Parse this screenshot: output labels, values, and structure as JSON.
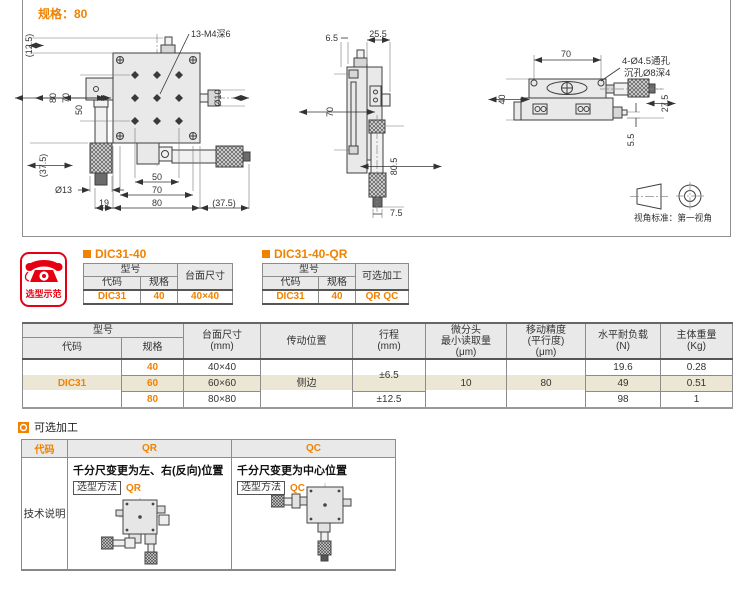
{
  "colors": {
    "orange": "#f08200",
    "red": "#e60012",
    "beige": "#ece7d4",
    "header_bg": "#e9e9e9"
  },
  "spec_label": "规格：80",
  "drawing": {
    "front": {
      "holes_label": "13-M4深6",
      "d10": "Ø10",
      "d13": "Ø13",
      "dim_12_5": "(12.5)",
      "dim_80_left": "80",
      "dim_70_left": "70",
      "dim_50_left": "50",
      "dim_37_5_left": "(37.5)",
      "dim_19": "19",
      "dim_50_bottom": "50",
      "dim_70_bottom": "70",
      "dim_80_bottom": "80",
      "dim_37_5_bottom": "(37.5)"
    },
    "side": {
      "dim_6_5": "6.5",
      "dim_25_5": "25.5",
      "dim_70": "70",
      "dim_80_5": "80.5",
      "dim_7_5": "7.5"
    },
    "end": {
      "dim_70": "70",
      "note1": "4-Ø4.5通孔",
      "note2": "沉孔Ø8深4",
      "dim_40": "40",
      "dim_27_5": "27.5",
      "dim_5_5": "5.5"
    },
    "projection_note": "视角标准：第一视角"
  },
  "selection_badge": {
    "label": "选型示范",
    "icon": "telephone-icon"
  },
  "example_tables": [
    {
      "title": "DIC31-40",
      "model_header": "型号",
      "code_header": "代码",
      "spec_header": "规格",
      "extra_header": "台面尺寸",
      "code": "DIC31",
      "spec": "40",
      "extra": "40×40"
    },
    {
      "title": "DIC31-40-QR",
      "model_header": "型号",
      "code_header": "代码",
      "spec_header": "规格",
      "extra_header": "可选加工",
      "code": "DIC31",
      "spec": "40",
      "extra": "QR QC"
    }
  ],
  "main_table": {
    "headers": {
      "model": "型号",
      "code": "代码",
      "spec": "规格",
      "surface": "台面尺寸\n(mm)",
      "drive": "传动位置",
      "travel": "行程\n(mm)",
      "micrometer": "微分头\n最小读取量\n(μm)",
      "accuracy": "移动精度\n(平行度)\n(μm)",
      "load": "水平耐负载\n(N)",
      "weight": "主体重量\n(Kg)"
    },
    "code": "DIC31",
    "drive": "侧边",
    "travel_40_60": "±6.5",
    "travel_80": "±12.5",
    "micrometer": "10",
    "accuracy": "80",
    "rows": [
      {
        "spec": "40",
        "surface": "40×40",
        "load": "19.6",
        "weight": "0.28"
      },
      {
        "spec": "60",
        "surface": "60×60",
        "load": "49",
        "weight": "0.51"
      },
      {
        "spec": "80",
        "surface": "80×80",
        "load": "98",
        "weight": "1"
      }
    ]
  },
  "optional_section": {
    "title": "可选加工",
    "code_header": "代码",
    "qr_header": "QR",
    "qc_header": "QC",
    "row_label": "技术说明",
    "qr": {
      "desc": "千分尺变更为左、右(反向)位置",
      "method_label": "选型方法",
      "code": "QR"
    },
    "qc": {
      "desc": "千分尺变更为中心位置",
      "method_label": "选型方法",
      "code": "QC"
    }
  }
}
